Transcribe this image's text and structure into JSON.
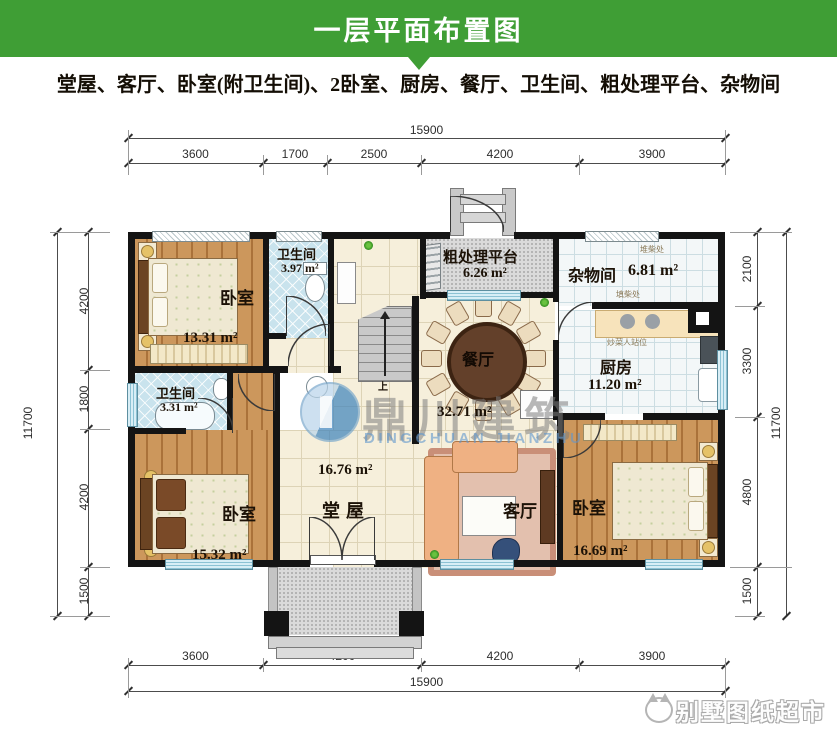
{
  "header": {
    "title": "一层平面布置图"
  },
  "subtitle": "堂屋、客厅、卧室(附卫生间)、2卧室、厨房、餐厅、卫生间、粗处理平台、杂物间",
  "dims": {
    "top_total": "15900",
    "top_segs": [
      "3600",
      "1700",
      "2500",
      "4200",
      "3900"
    ],
    "bottom_total": "15900",
    "bottom_segs": [
      "3600",
      "4200",
      "4200",
      "3900"
    ],
    "left_total": "11700",
    "left_segs": [
      "4200",
      "1800",
      "4200",
      "1500"
    ],
    "right_total": "11700",
    "right_segs": [
      "2100",
      "3300",
      "4800",
      "1500"
    ]
  },
  "rooms": {
    "bedroom_tl": {
      "name": "卧室",
      "area": "13.31 m²"
    },
    "bath_top": {
      "name": "卫生间",
      "area": "3.97 m²"
    },
    "platform": {
      "name": "粗处理平台",
      "area": "6.26 m²"
    },
    "storage": {
      "name": "杂物间",
      "area": "6.81 m²"
    },
    "kitchen": {
      "name": "厨房",
      "area": "11.20 m²"
    },
    "dining": {
      "name": "餐厅",
      "area": "32.71 m²"
    },
    "bath_left": {
      "name": "卫生间",
      "area": "3.31 m²"
    },
    "hall": {
      "name": "堂屋",
      "area": "16.76 m²"
    },
    "living": {
      "name": "客厅"
    },
    "bedroom_bl": {
      "name": "卧室",
      "area": "15.32 m²"
    },
    "bedroom_br": {
      "name": "卧室",
      "area": "16.69 m²"
    }
  },
  "notes": {
    "wood_stack": "堆柴处",
    "wood_fill": "填柴处",
    "cook_spot": "炒菜人站位",
    "stair_up": "上"
  },
  "watermark": {
    "cn": "鼎川建筑",
    "en": "DINGCHUAN JIANZHU"
  },
  "corner_brand": "别墅图纸超市",
  "colors": {
    "header_green": "#3f9e35",
    "wall": "#141414",
    "window": "#d8eef6"
  }
}
